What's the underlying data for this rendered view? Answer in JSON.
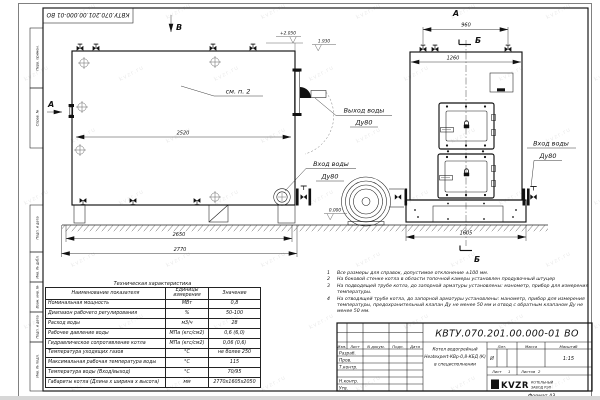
{
  "sheet": {
    "stamp": "КВТУ.070.201.00.000-01 ВО",
    "watermark": "kvzr.ru"
  },
  "margin": {
    "c1": "Перв. примен.",
    "c2": "Справ. №",
    "c3": "Подп. и дата",
    "c4": "Инв. № дубл.",
    "c5": "Взам. инв. №",
    "c6": "Подп. и дата",
    "c7": "Инв. № подл."
  },
  "side_view": {
    "label_top": "В",
    "label_left": "А",
    "see_note": "см. п. 2",
    "elev_top": "+2.050",
    "elev_outlet": "1.930",
    "outlet_line1": "Выход воды",
    "outlet_line2": "Ду80",
    "inlet_line1": "Вход воды",
    "inlet_line2": "Ду80",
    "dim_body": "2520",
    "dim_mid": "2650",
    "dim_overall": "2770"
  },
  "front_view": {
    "label_top": "А",
    "section_mark_top": "Б",
    "section_mark_bottom": "Б",
    "dim_valves": "960",
    "dim_width": "1260",
    "dim_base": "1605",
    "elev_zero": "0.000",
    "inlet_line1": "Вход воды",
    "inlet_line2": "Ду80"
  },
  "tech": {
    "title": "Техническая характеристика",
    "h_name": "Наименование показателя",
    "h_unit": "Единицы измерения",
    "h_value": "Значение",
    "rows": [
      {
        "n": "Номинальная мощность",
        "u": "МВт",
        "v": "0,8"
      },
      {
        "n": "Диапазон рабочего регулирования",
        "u": "%",
        "v": "50-100"
      },
      {
        "n": "Расход воды",
        "u": "м3/ч",
        "v": "28"
      },
      {
        "n": "Рабочее давление воды",
        "u": "МПа (кгс/см2)",
        "v": "0,6 (6,0)"
      },
      {
        "n": "Гидравлическое сопротивление котла",
        "u": "МПа (кгс/см2)",
        "v": "0,06 (0,6)"
      },
      {
        "n": "Температура уходящих газов",
        "u": "°С",
        "v": "не более 250"
      },
      {
        "n": "Максимальная рабочая температура воды",
        "u": "°С",
        "v": "115"
      },
      {
        "n": "Температура воды (Вход/выход)",
        "u": "°С",
        "v": "70/95"
      },
      {
        "n": "Габариты котла (Длина х ширина х высота)",
        "u": "мм",
        "v": "2770х1605х2050"
      }
    ]
  },
  "notes": [
    {
      "num": "1",
      "text": "Все размеры для справок, допустимое отклонение ±100 мм."
    },
    {
      "num": "2",
      "text": "На боковой стенке котла в области топочной камеры установлен продувочный штуцер"
    },
    {
      "num": "3",
      "text": "На подводящей трубе котла, до запорной арматуры установлены: манометр, прибор для измерения температуры."
    },
    {
      "num": "4",
      "text": "На отводящей трубе котла, до запорной арматуры установлены: манометр, прибор для измерения температуры, предохранительный клапан Ду не менее 50 мм и отвод с обратным клапаном Ду не менее 50 мм."
    }
  ],
  "tb": {
    "name1": "Котел водогрейный",
    "name2": "Heatexpert-КВр-0,8-КБД (К)",
    "name3": "в специсполнении",
    "lit": "Лит.",
    "massa": "Масса",
    "masshtab": "Масштаб",
    "lit_v": "И",
    "scale_v": "1:15",
    "list": "Лист",
    "list_v": "1",
    "listov": "Листов",
    "listov_v": "2",
    "izm": "Изм.",
    "list_col": "Лист",
    "ndok": "N докум.",
    "podp": "Подп.",
    "data": "Дата",
    "razrab": "Разраб.",
    "prov": "Пров.",
    "tkontr": "Т.контр.",
    "nkontr": "Н.контр.",
    "utv": "Утв.",
    "logo": "KVZR",
    "logo1": "КОТЕЛЬНЫЙ",
    "logo2": "ЗАВОД РЭП",
    "format": "Формат  А3"
  }
}
